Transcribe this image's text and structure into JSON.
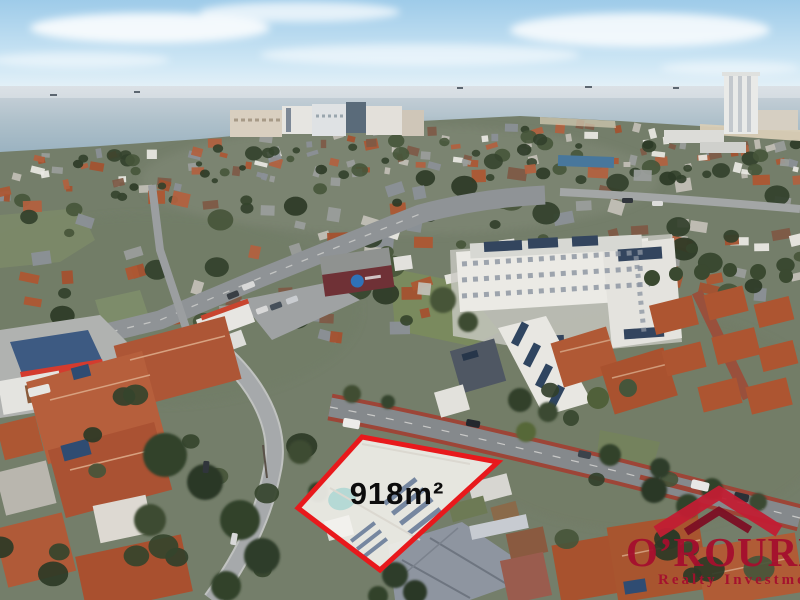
{
  "image": {
    "kind": "aerial-drone-photograph",
    "description": "Aerial photo of a coastal suburb with ocean horizon, a for-sale block outlined in red, and a realty watermark logo in the bottom-right corner"
  },
  "property": {
    "area_label": "918m²",
    "outline_color": "#e8191c",
    "overlay_fill": "#efeee8",
    "label_color": "#0c0c0c"
  },
  "branding": {
    "name": "O’ROURKE",
    "tagline": "Realty Investments",
    "text_color": "#a50f2e",
    "roof_icon_light": "#c21e33",
    "roof_icon_dark": "#7d0f24"
  },
  "palette": {
    "sky_top": "#9ecbe9",
    "sky_horizon": "#e7f2f8",
    "sea_far": "#ccd4db",
    "sea_near": "#97b0bf",
    "sand": "#d9ceb6",
    "land": "#747e6a",
    "road_light": "#a6a9ab",
    "road_dark": "#85898c",
    "bike_lane_red": "#9d4537",
    "terracotta": "#ad5733",
    "roof_gray": "#8b9097",
    "building_white": "#eae9e4",
    "tree_dark": "#35442d",
    "solar_blue": "#33455e",
    "pool": "#a9d6d2"
  }
}
